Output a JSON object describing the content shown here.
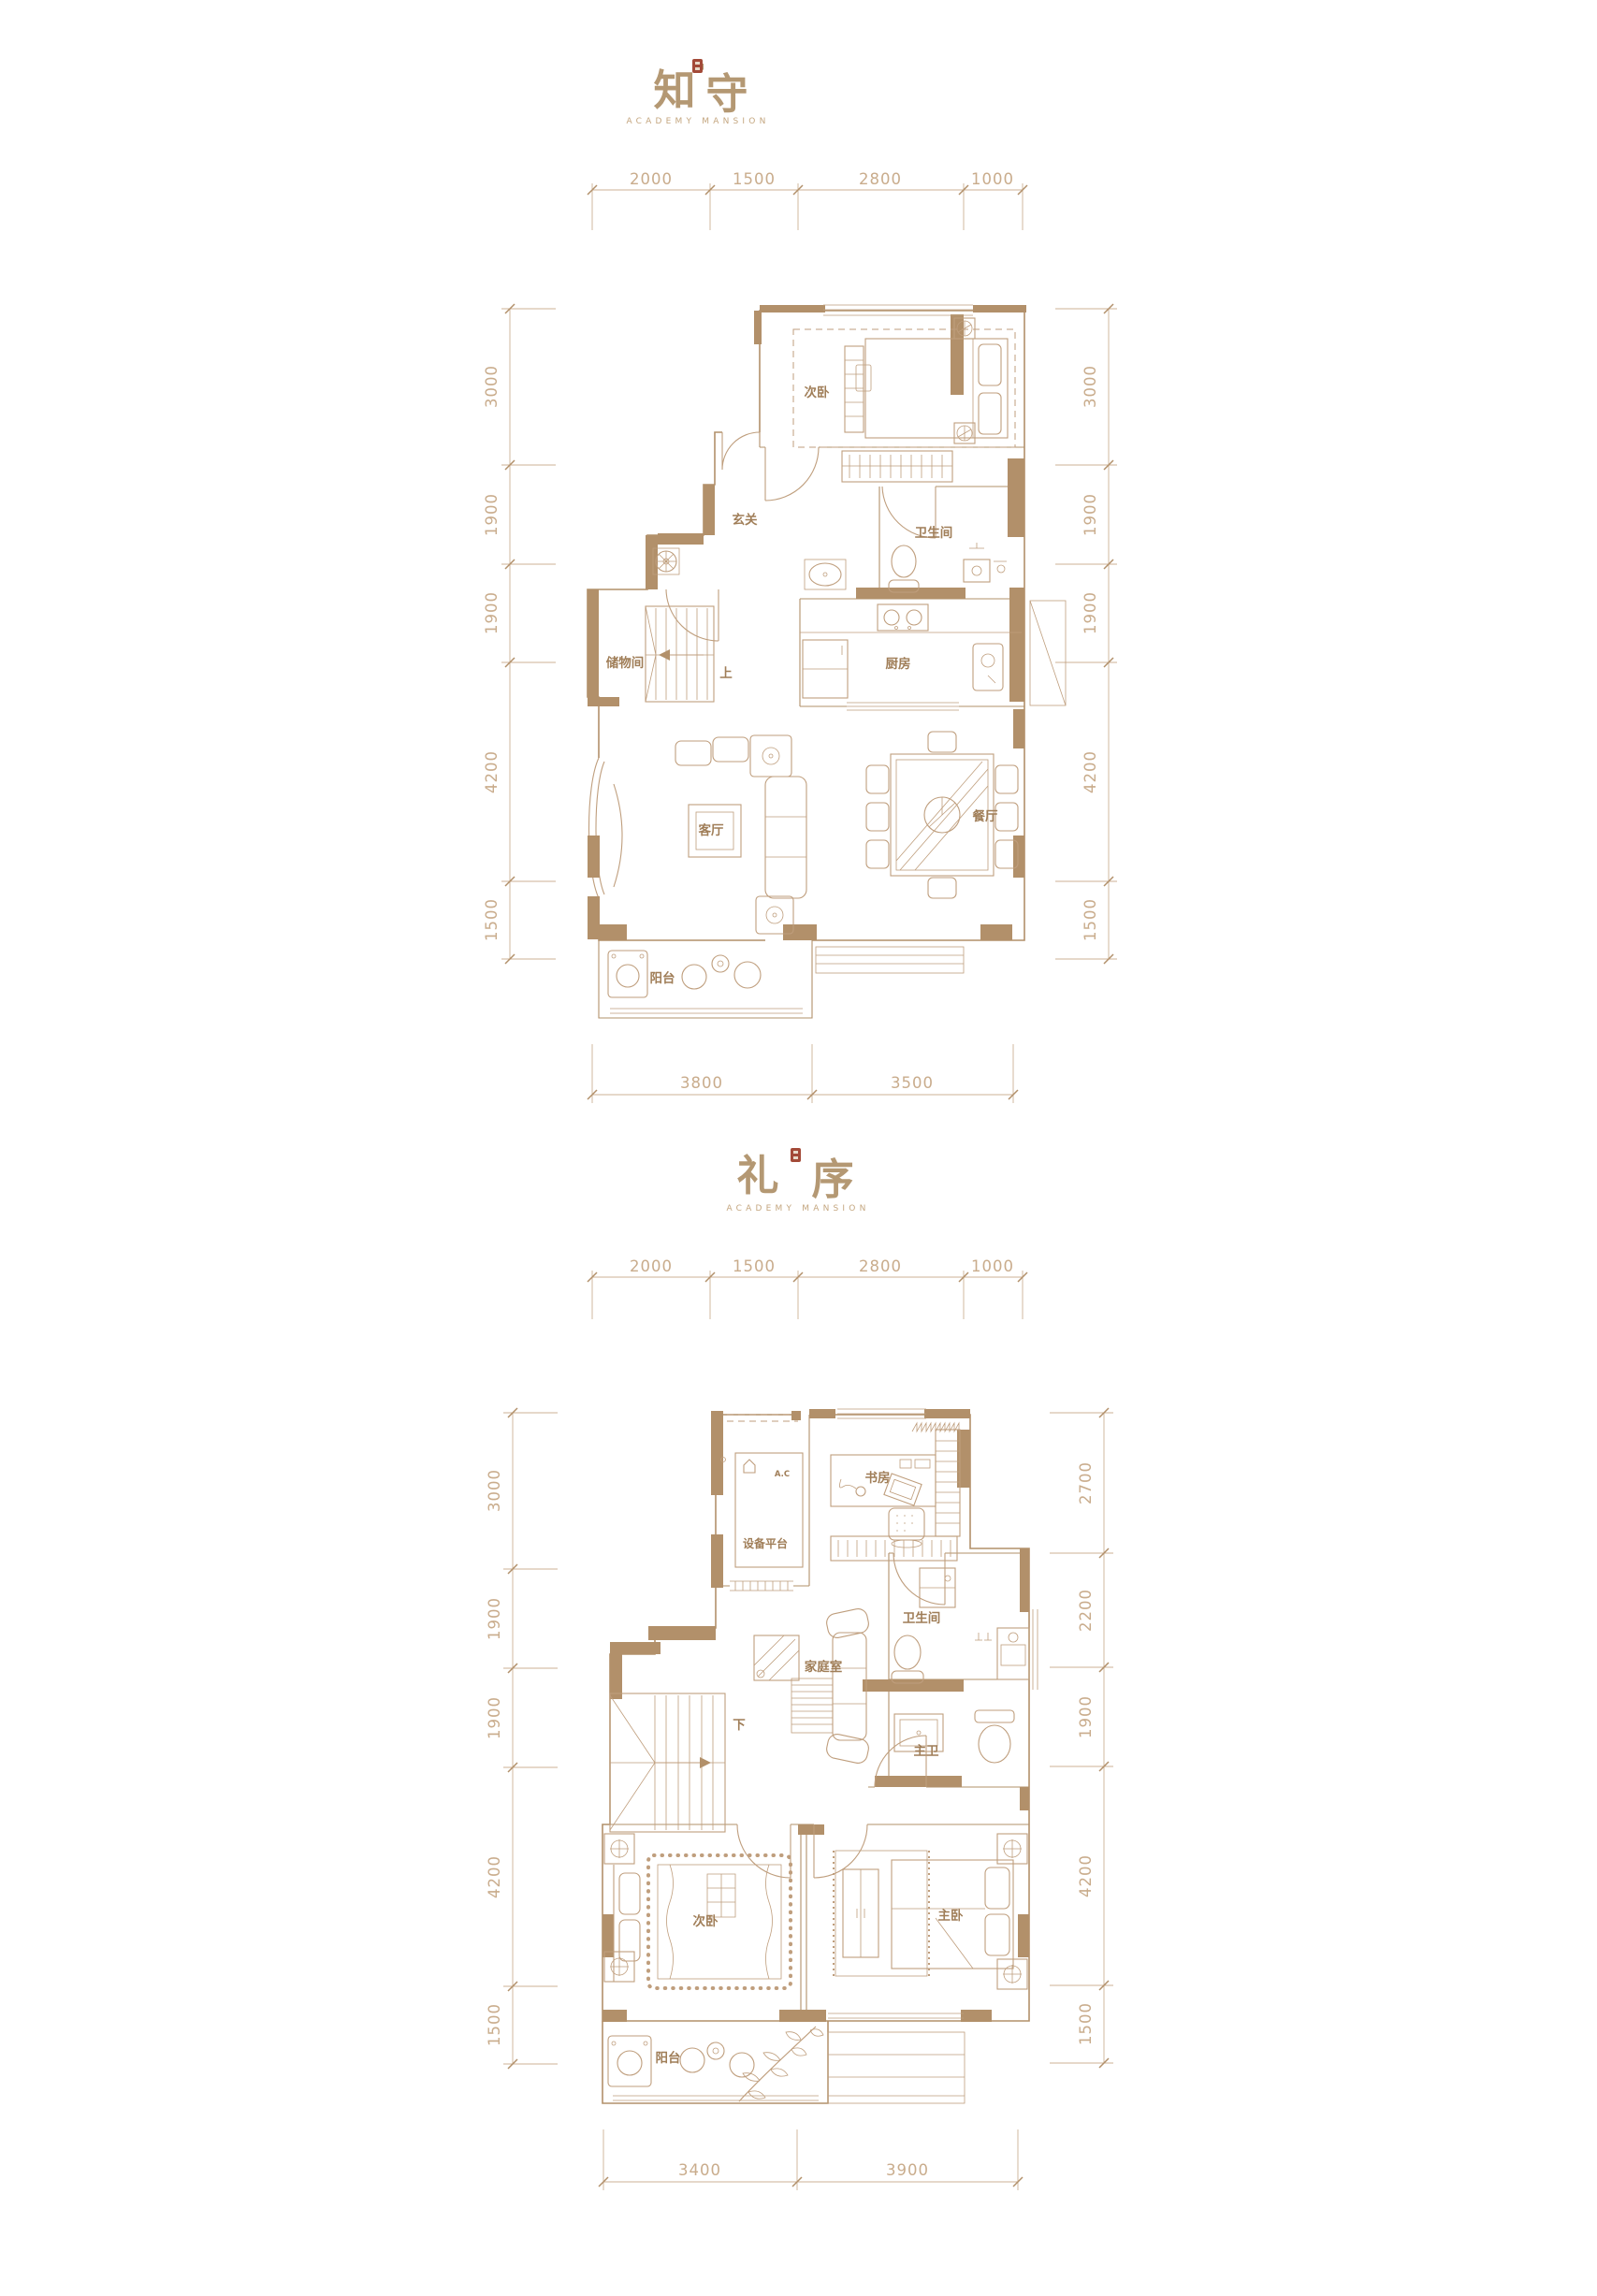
{
  "colors": {
    "wall": "#b2906a",
    "furniture_line": "#bf9e7d",
    "dimension_line": "#ccb195",
    "room_label": "#a07e58",
    "title": "#b49873",
    "seal_red": "#a34a38",
    "background": "#ffffff"
  },
  "plan1": {
    "title_left": "知",
    "title_quote": "'",
    "title_right": "守",
    "subtitle": "ACADEMY MANSION",
    "dims": {
      "top": [
        "2000",
        "1500",
        "2800",
        "1000"
      ],
      "left": [
        "3000",
        "1900",
        "1900",
        "4200",
        "1500"
      ],
      "right": [
        "3000",
        "1900",
        "1900",
        "4200",
        "1500"
      ],
      "bottom": [
        "3800",
        "3500"
      ]
    },
    "labels": {
      "bedroom2": "次卧",
      "foyer": "玄关",
      "bath": "卫生间",
      "storage": "储物间",
      "stairs": "上",
      "kitchen": "厨房",
      "living": "客厅",
      "dining": "餐厅",
      "balcony": "阳台"
    }
  },
  "plan2": {
    "title_left": "礼",
    "title_quote": "'",
    "title_right": "序",
    "subtitle": "ACADEMY MANSION",
    "dims": {
      "top": [
        "2000",
        "1500",
        "2800",
        "1000"
      ],
      "left": [
        "3000",
        "1900",
        "1900",
        "4200",
        "1500"
      ],
      "right": [
        "2700",
        "2200",
        "1900",
        "4200",
        "1500"
      ],
      "bottom": [
        "3400",
        "3900"
      ]
    },
    "labels": {
      "study": "书房",
      "equipment": "设备平台",
      "ac": "A.C",
      "bath": "卫生间",
      "family": "家庭室",
      "stairs": "下",
      "masterbath": "主卫",
      "bedroom2": "次卧",
      "master": "主卧",
      "balcony": "阳台"
    }
  }
}
